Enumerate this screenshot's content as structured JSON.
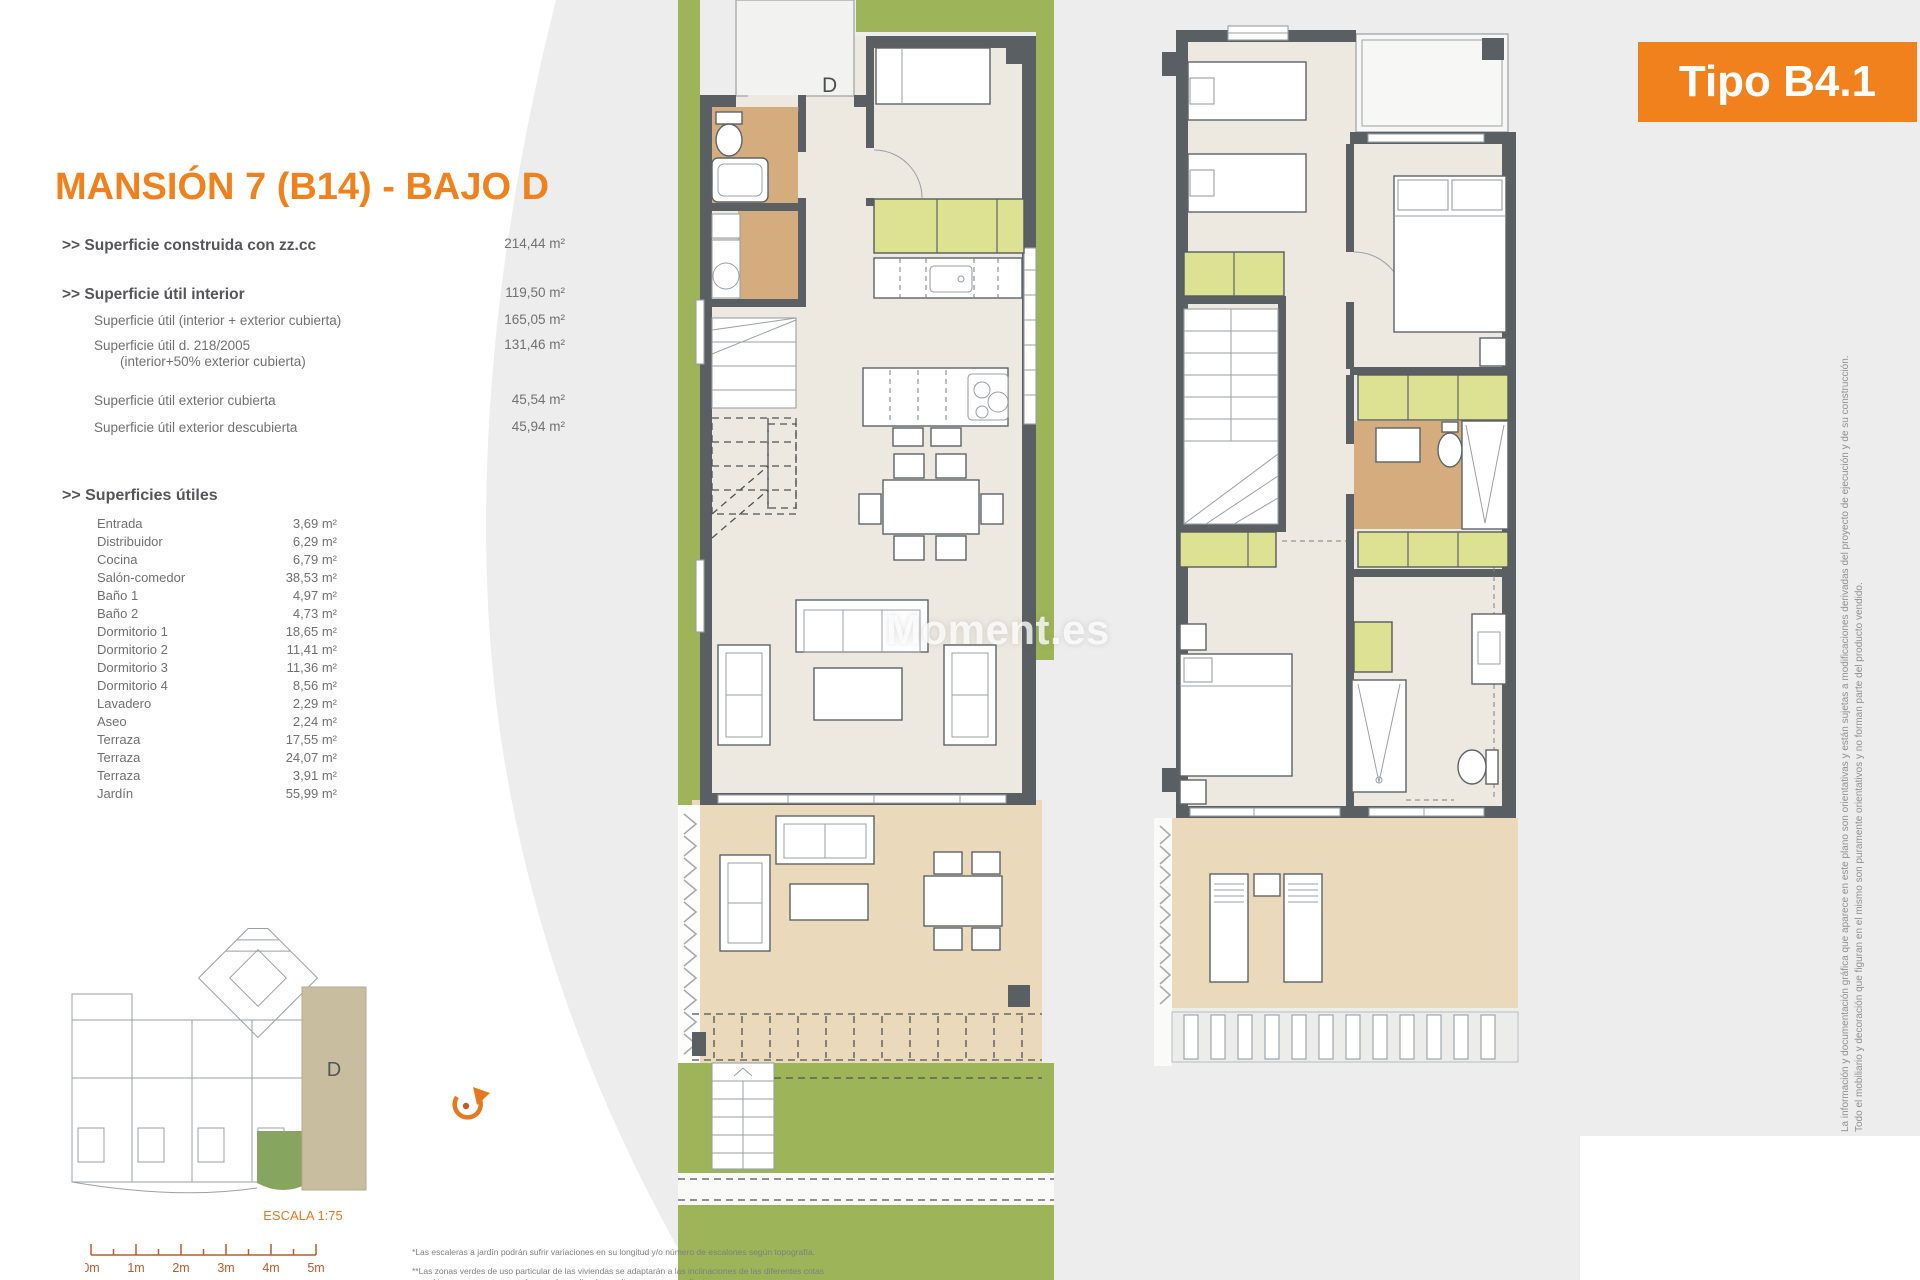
{
  "page": {
    "title": "MANSIÓN 7 (B14) - BAJO D",
    "type_badge": "Tipo B4.1",
    "watermark": "Moment.es",
    "unit_letter": "D"
  },
  "areas": {
    "summary": [
      {
        "label": ">> Superficie construida con zz.cc",
        "value": "214,44 m²"
      },
      {
        "label": ">> Superficie útil interior",
        "value": "119,50 m²"
      },
      {
        "label": "Superficie útil (interior + exterior cubierta)",
        "value": "165,05 m²"
      },
      {
        "label": "Superficie útil  d. 218/2005",
        "label2": "(interior+50% exterior cubierta)",
        "value": "131,46 m²"
      },
      {
        "label": "Superficie útil exterior cubierta",
        "value": "45,54 m²"
      },
      {
        "label": "Superficie útil exterior descubierta",
        "value": "45,94 m²"
      }
    ],
    "useful_title": ">> Superficies útiles",
    "rooms": [
      {
        "name": "Entrada",
        "area": "3,69 m²"
      },
      {
        "name": "Distribuidor",
        "area": "6,29 m²"
      },
      {
        "name": "Cocina",
        "area": "6,79 m²"
      },
      {
        "name": "Salón-comedor",
        "area": "38,53 m²"
      },
      {
        "name": "Baño 1",
        "area": "4,97 m²"
      },
      {
        "name": "Baño 2",
        "area": "4,73 m²"
      },
      {
        "name": "Dormitorio 1",
        "area": "18,65 m²"
      },
      {
        "name": "Dormitorio 2",
        "area": "11,41 m²"
      },
      {
        "name": "Dormitorio 3",
        "area": "11,36 m²"
      },
      {
        "name": "Dormitorio 4",
        "area": "8,56 m²"
      },
      {
        "name": "Lavadero",
        "area": "2,29 m²"
      },
      {
        "name": "Aseo",
        "area": "2,24 m²"
      },
      {
        "name": "Terraza",
        "area": "17,55 m²"
      },
      {
        "name": "Terraza",
        "area": "24,07 m²"
      },
      {
        "name": "Terraza",
        "area": "3,91 m²"
      },
      {
        "name": "Jardín",
        "area": "55,99 m²"
      }
    ]
  },
  "scale": {
    "label": "ESCALA 1:75",
    "ticks": [
      "0m",
      "1m",
      "2m",
      "3m",
      "4m",
      "5m"
    ]
  },
  "footnotes": [
    "*Las escaleras a jardín podrán sufrir variaciones en su longitud y/o número de escalones según topografía.",
    "**Las zonas verdes de uso particular de las viviendas se adaptarán a las inclinaciones de las diferentes cotas",
    "que el terreno presenta en cada parcela, pudiendo resultar zonas en pendiente"
  ],
  "disclaimer": [
    "La información y documentación gráfica que aparece en este plano son orientativas y están sujetas a modificaciones derivadas del proyecto de ejecución y de su construcción.",
    "Todo el mobiliario y decoración que figuran en el mismo son puramente orientativos y no forman parte del producto vendido."
  ],
  "colors": {
    "accent_orange": "#F0811C",
    "scale_orange": "#C05A2A",
    "wall_gray": "#5A5F63",
    "floor_cream": "#EDE9E1",
    "bath_tan": "#D4AC7E",
    "terrace_tan": "#EBD9BC",
    "cabinet_lime": "#DCE291",
    "garden_green": "#9DB459",
    "text_gray": "#6F7173",
    "background_gray": "#ECEDEC"
  }
}
